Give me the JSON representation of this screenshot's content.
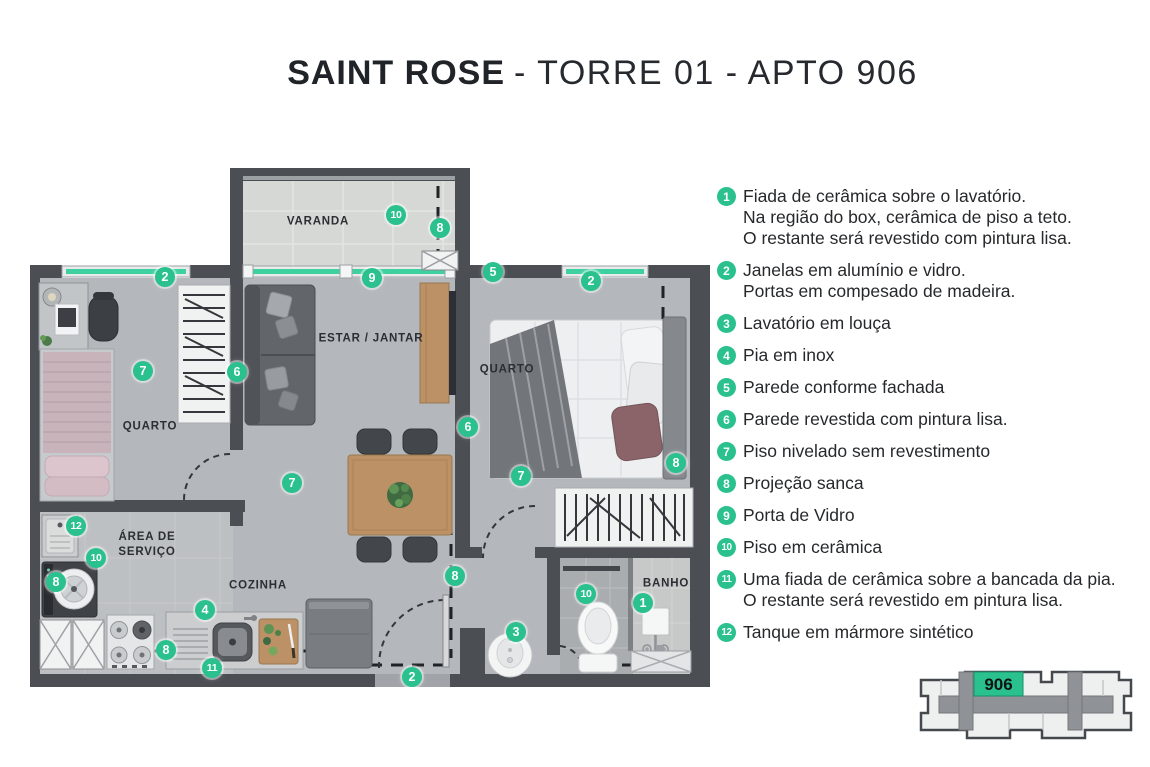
{
  "title": {
    "brand": "SAINT ROSE",
    "rest": "- TORRE 01 - APTO 906"
  },
  "colors": {
    "accent_green": "#2AC18E",
    "wall": "#4B4F54",
    "floor": "#B4B8BC",
    "window_glass": "#3FD0A0"
  },
  "plan": {
    "rooms": [
      {
        "label": "VARANDA",
        "x": 288,
        "y": 54
      },
      {
        "label": "QUARTO",
        "x": 120,
        "y": 259
      },
      {
        "label": "ESTAR / JANTAR",
        "x": 341,
        "y": 171
      },
      {
        "label": "QUARTO",
        "x": 477,
        "y": 202
      },
      {
        "label": "ÁREA DE\nSERVIÇO",
        "x": 117,
        "y": 377
      },
      {
        "label": "COZINHA",
        "x": 228,
        "y": 418
      },
      {
        "label": "BANHO",
        "x": 636,
        "y": 416
      }
    ],
    "markers": [
      {
        "n": "2",
        "x": 135,
        "y": 109
      },
      {
        "n": "10",
        "x": 366,
        "y": 47
      },
      {
        "n": "8",
        "x": 410,
        "y": 60
      },
      {
        "n": "9",
        "x": 342,
        "y": 110
      },
      {
        "n": "5",
        "x": 463,
        "y": 104
      },
      {
        "n": "2",
        "x": 561,
        "y": 113
      },
      {
        "n": "7",
        "x": 113,
        "y": 203
      },
      {
        "n": "6",
        "x": 207,
        "y": 204
      },
      {
        "n": "6",
        "x": 438,
        "y": 259
      },
      {
        "n": "7",
        "x": 262,
        "y": 315
      },
      {
        "n": "7",
        "x": 491,
        "y": 308
      },
      {
        "n": "8",
        "x": 646,
        "y": 295
      },
      {
        "n": "12",
        "x": 46,
        "y": 358
      },
      {
        "n": "10",
        "x": 66,
        "y": 390
      },
      {
        "n": "8",
        "x": 26,
        "y": 414
      },
      {
        "n": "4",
        "x": 175,
        "y": 442
      },
      {
        "n": "8",
        "x": 136,
        "y": 482
      },
      {
        "n": "11",
        "x": 182,
        "y": 500
      },
      {
        "n": "8",
        "x": 425,
        "y": 408
      },
      {
        "n": "2",
        "x": 382,
        "y": 509
      },
      {
        "n": "3",
        "x": 486,
        "y": 464
      },
      {
        "n": "10",
        "x": 556,
        "y": 426
      },
      {
        "n": "1",
        "x": 613,
        "y": 435
      }
    ]
  },
  "legend": {
    "items": [
      {
        "n": "1",
        "lines": [
          "Fiada de cerâmica sobre o lavatório.",
          "Na região do box, cerâmica de piso a teto.",
          "O restante será revestido com pintura lisa."
        ]
      },
      {
        "n": "2",
        "lines": [
          "Janelas em alumínio e vidro.",
          "Portas em compesado de madeira."
        ]
      },
      {
        "n": "3",
        "lines": [
          "Lavatório em louça"
        ]
      },
      {
        "n": "4",
        "lines": [
          "Pia em inox"
        ]
      },
      {
        "n": "5",
        "lines": [
          "Parede conforme fachada"
        ]
      },
      {
        "n": "6",
        "lines": [
          "Parede revestida com pintura lisa."
        ]
      },
      {
        "n": "7",
        "lines": [
          "Piso nivelado sem revestimento"
        ]
      },
      {
        "n": "8",
        "lines": [
          "Projeção sanca"
        ]
      },
      {
        "n": "9",
        "lines": [
          "Porta de Vidro"
        ]
      },
      {
        "n": "10",
        "lines": [
          "Piso em cerâmica"
        ]
      },
      {
        "n": "11",
        "lines": [
          "Uma fiada de cerâmica sobre a bancada da pia.",
          "O restante será revestido em pintura lisa."
        ]
      },
      {
        "n": "12",
        "lines": [
          "Tanque em mármore sintético"
        ]
      }
    ]
  },
  "keyplan": {
    "unit": "906"
  }
}
